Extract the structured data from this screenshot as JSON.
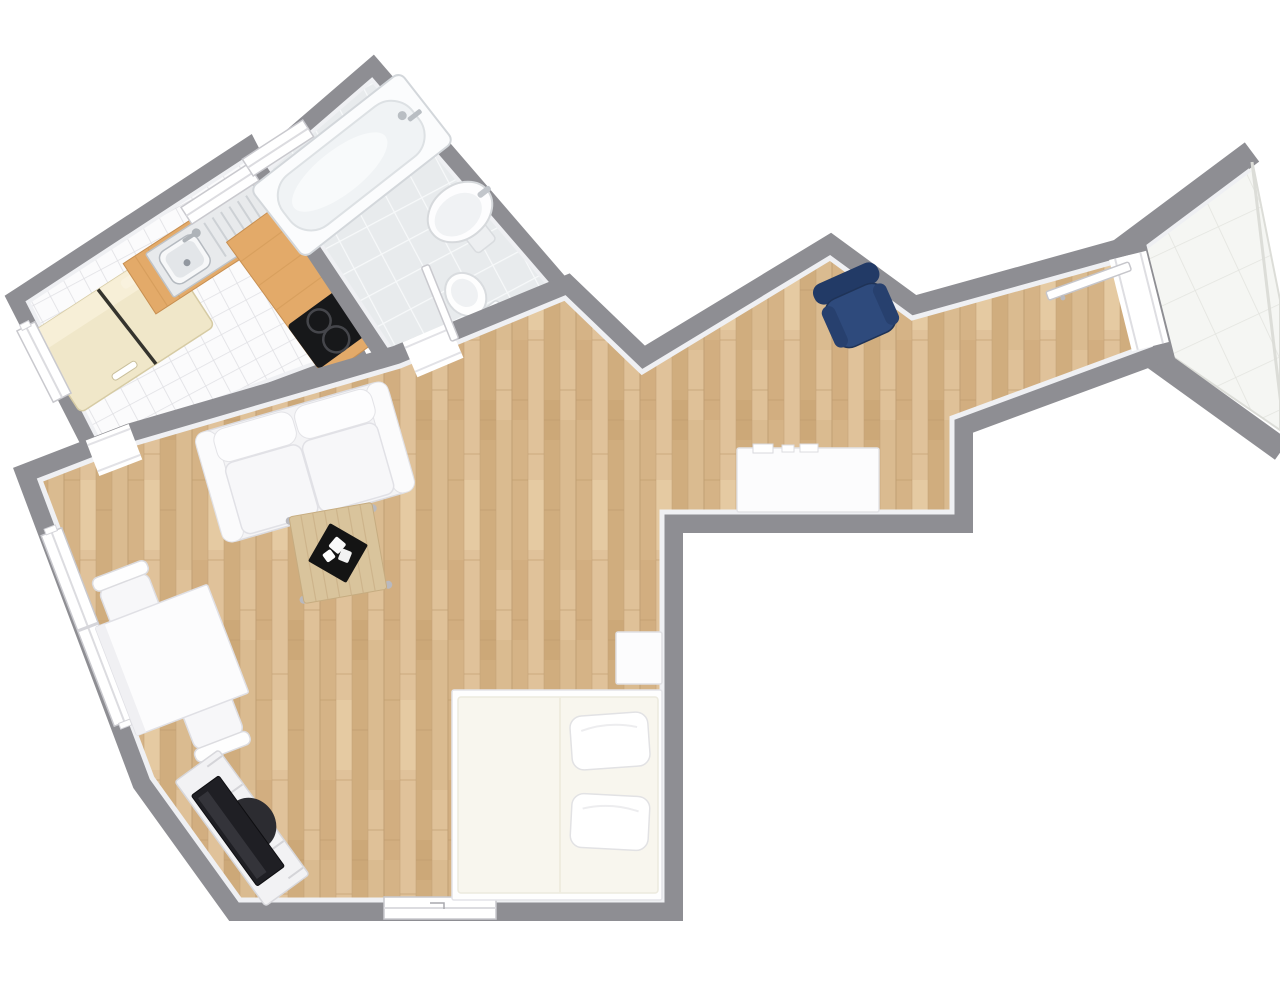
{
  "scene": {
    "kind": "3d-floor-plan-top-view",
    "background": "#ffffff",
    "width": 1280,
    "height": 989
  },
  "colors": {
    "wall": "#8e8e93",
    "wall_light": "#d7d7d3",
    "baseboard": "#eff0f3",
    "wood_floor": "#dcbd92",
    "kitchen_tile": "#fbfbfc",
    "bath_tile": "#e8ebed",
    "entry_tile": "#f5f6f3",
    "counter_wood": "#e3aa69",
    "fridge": "#f0e7c9",
    "cooktop": "#17181a",
    "steel": "#e8eaec",
    "armchair_seat": "#2e4a7c",
    "armchair_back": "#223a66",
    "tv_screen": "#1f1f24",
    "sofa": "#f4f4f6",
    "bed_mattress": "#f8f6ee",
    "white_furniture": "#fcfcfd",
    "coffee_table_wood": "#d9c49c",
    "tray": "#141414"
  },
  "rooms": [
    {
      "name": "kitchen",
      "floor": "white mosaic tile",
      "furniture": [
        "fridge-freezer",
        "sink counter",
        "corner counter",
        "cooktop"
      ]
    },
    {
      "name": "bathroom",
      "floor": "grey tile",
      "furniture": [
        "bathtub",
        "washbasin",
        "toilet"
      ]
    },
    {
      "name": "living-sleeping-room",
      "floor": "oak parquet",
      "furniture": [
        "sofa",
        "coffee-table",
        "dining-table",
        "dining-chairs",
        "tv-sideboard",
        "tv",
        "double-bed",
        "pillows",
        "nightstand",
        "desk",
        "armchair"
      ]
    },
    {
      "name": "entry-corridor",
      "floor": "oak parquet",
      "furniture": [
        "entry-door"
      ]
    },
    {
      "name": "entrance-landing",
      "floor": "white tile",
      "furniture": []
    }
  ],
  "openings": {
    "windows": [
      "kitchen-left-window",
      "kitchen-sink-window",
      "bathroom-niche-window",
      "living-room-tall-window",
      "bottom-wall-window"
    ],
    "doors": [
      "entry-door-open",
      "bathroom-door-open",
      "kitchen-doorway"
    ]
  },
  "furniture_counts": {
    "chairs": 2,
    "pillows": 2,
    "beds": 1,
    "sofas": 1,
    "armchairs": 1,
    "tables": 3
  }
}
